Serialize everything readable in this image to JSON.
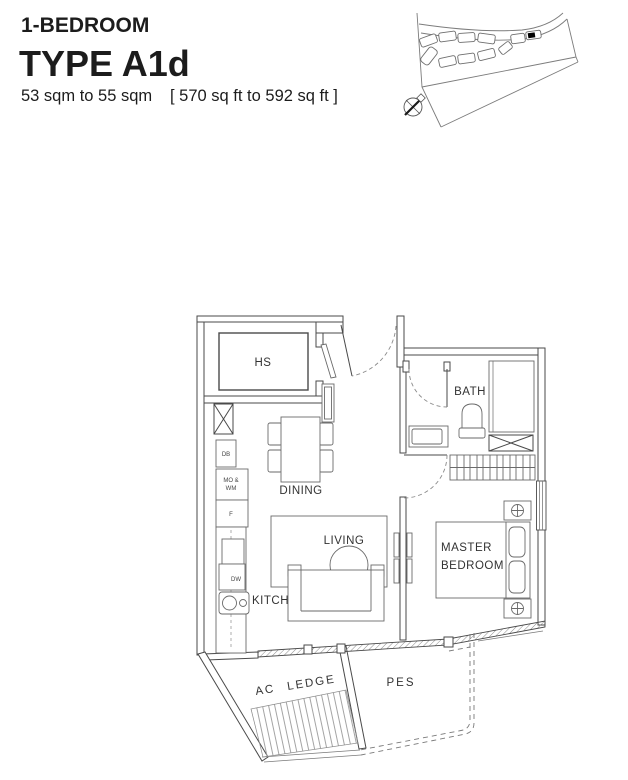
{
  "header": {
    "category": "1-BEDROOM",
    "type_name": "TYPE A1d",
    "area_metric": "53 sqm to 55 sqm",
    "area_imperial": "[ 570 sq ft to 592 sq ft ]"
  },
  "floor_plan": {
    "rooms": {
      "household_shelter": "HS",
      "dining": "DINING",
      "living": "LIVING",
      "kitchen": "KITCHEN",
      "bath": "BATH",
      "master_bedroom_line1": "MASTER",
      "master_bedroom_line2": "BEDROOM",
      "ac_ledge": "AC LEDGE",
      "pes": "PES"
    },
    "appliances": {
      "db": "DB",
      "mo_wm_line1": "MO &",
      "mo_wm_line2": "WM",
      "fridge": "F",
      "dw": "DW"
    }
  },
  "colors": {
    "background": "#ffffff",
    "wall_stroke": "#4a4a4a",
    "furniture_stroke": "#6a6a6a",
    "label_text": "#333333",
    "site_key_stroke": "#7c7c7c",
    "highlighted_unit": "#000000"
  }
}
